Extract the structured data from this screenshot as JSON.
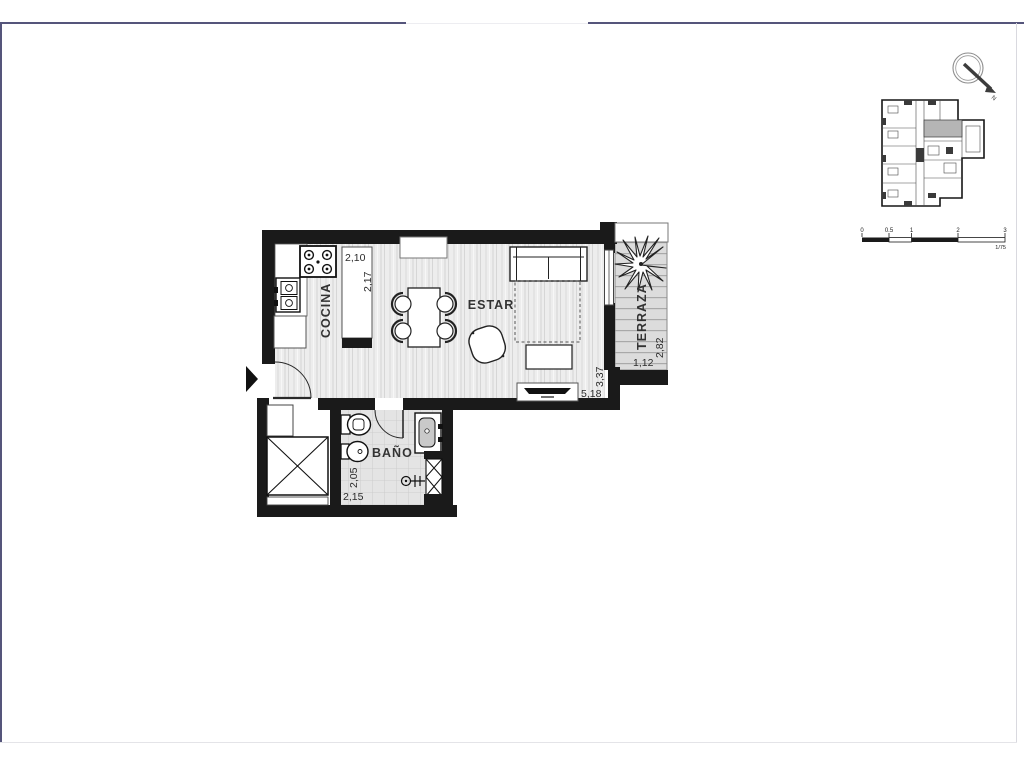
{
  "page": {
    "background": "#ffffff",
    "frame_color": "#55557b"
  },
  "plan": {
    "labels": {
      "cocina": "COCINA",
      "estar": "ESTAR",
      "bano": "BAÑO",
      "terraza": "TERRAZA"
    },
    "dims": {
      "island_w": "2,10",
      "island_l": "2,17",
      "estar_w": "5,18",
      "estar_h": "3,37",
      "terraza_w": "1,12",
      "terraza_h": "2,82",
      "bano_h": "2,05",
      "bano_w": "2,15"
    }
  },
  "annotations": {
    "north": "N"
  },
  "scale_bar": {
    "ticks": [
      "0",
      "0.5",
      "1",
      "2",
      "3"
    ],
    "ratio": "1/75"
  },
  "colors": {
    "wall": "#1a1a1a",
    "floor_wood": "#ededed",
    "floor_tile": "#e4e4e4",
    "terrace_deck": "#dcdcdc",
    "keyplan_highlight": "#b5b5b5"
  }
}
